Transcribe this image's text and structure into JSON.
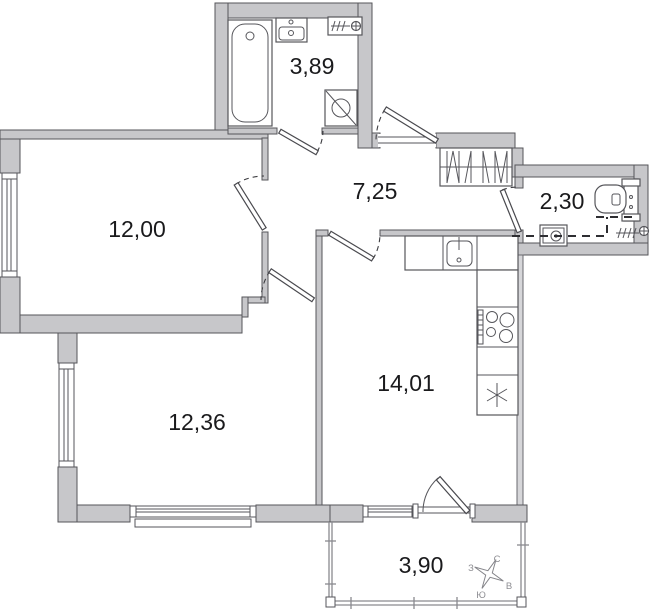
{
  "plan": {
    "type": "apartment-floor-plan",
    "rooms": [
      {
        "name": "bathroom",
        "area": "3,89"
      },
      {
        "name": "living-room",
        "area": "12,00"
      },
      {
        "name": "hallway",
        "area": "7,25"
      },
      {
        "name": "wc",
        "area": "2,30"
      },
      {
        "name": "kitchen",
        "area": "14,01"
      },
      {
        "name": "bedroom",
        "area": "12,36"
      },
      {
        "name": "balcony",
        "area": "3,90"
      }
    ],
    "compass": {
      "n": "С",
      "w": "З",
      "e": "В",
      "s": "Ю"
    },
    "fixtures": [
      "bathtub-icon",
      "sink-icon",
      "towel-radiator-icon",
      "washing-machine-icon",
      "wardrobe-icon",
      "kitchen-sink-icon",
      "stove-icon",
      "fridge-icon",
      "toilet-icon",
      "compass-rose-icon"
    ],
    "colors": {
      "wall": "#c7c7ca",
      "stroke": "#55555a",
      "label": "#1a1a1c",
      "compass_label": "#8e8e93",
      "background": "#ffffff"
    }
  }
}
